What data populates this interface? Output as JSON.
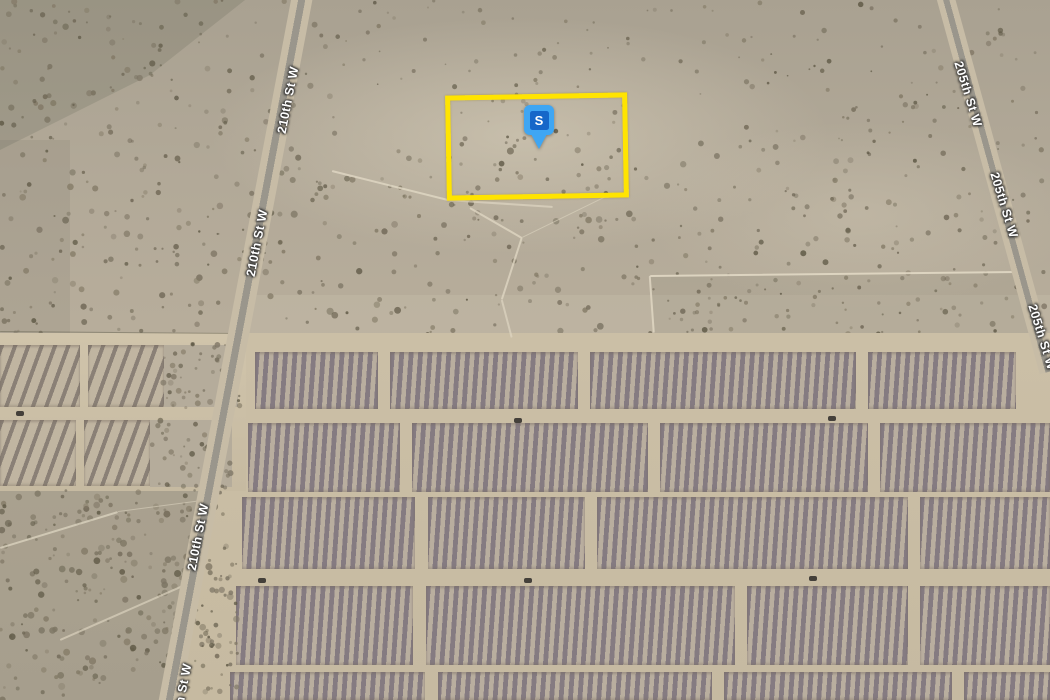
{
  "map": {
    "type": "satellite-aerial-view",
    "colors": {
      "desert": "#b1a897",
      "farm_dirt": "#d0c4ab",
      "farm_dirt_dark": "#c6baa1",
      "asphalt": "#9a968c",
      "road_shoulder": "#c7bca6",
      "panel_dark": "#857b81",
      "panel_light": "#b9ae9f",
      "panel_left_dark": "#8a8076",
      "panel_left_light": "#c0b5a1",
      "scrub": "#b5ac9b",
      "speckle_palette": [
        "#6f6755",
        "#7d7564",
        "#5f5946",
        "#837a66"
      ],
      "parcel_outline": "#ffe400",
      "marker_head": "#3fa6f3",
      "marker_inner": "#1667c9",
      "label_text": "#ffffff",
      "vehicle": "#44403a",
      "trail": "rgba(224,216,196,0.85)"
    },
    "marker": {
      "label": "S",
      "x": 524,
      "y": 105
    },
    "parcel": {
      "x": 446,
      "y": 94,
      "w": 182,
      "h": 105,
      "rot": -1,
      "stroke": 5
    },
    "road_labels": [
      {
        "text": "210th St W",
        "x": 288,
        "y": 100,
        "rot": -79
      },
      {
        "text": "210th St W",
        "x": 257,
        "y": 243,
        "rot": -79
      },
      {
        "text": "210th St W",
        "x": 198,
        "y": 537,
        "rot": -79
      },
      {
        "text": "210th St W",
        "x": 181,
        "y": 697,
        "rot": -79
      },
      {
        "text": "205th St W",
        "x": 968,
        "y": 94,
        "rot": 73
      },
      {
        "text": "205th St W",
        "x": 1004,
        "y": 205,
        "rot": 73
      },
      {
        "text": "205th St W",
        "x": 1042,
        "y": 337,
        "rot": 73
      }
    ],
    "roads": [
      {
        "name": "210th St W",
        "x1": 303,
        "y1": -10,
        "x2": 167,
        "y2": 710,
        "asphalt": 7,
        "shoulder": 7
      },
      {
        "name": "205th St W",
        "x1": 943,
        "y1": -10,
        "x2": 1048,
        "y2": 372,
        "asphalt": 6,
        "shoulder": 6
      }
    ],
    "solar_farm": {
      "grounds": [
        {
          "poly": [
            [
              246,
              333
            ],
            [
              1050,
              333
            ],
            [
              1050,
              700
            ],
            [
              176,
              700
            ]
          ]
        },
        {
          "rect": [
            0,
            333,
            246,
            158
          ]
        }
      ],
      "bands_main": [
        {
          "y": 352,
          "h": 57,
          "segments": [
            [
              255,
              378
            ],
            [
              390,
              578
            ],
            [
              590,
              856
            ],
            [
              868,
              1016
            ]
          ]
        },
        {
          "y": 423,
          "h": 69,
          "segments": [
            [
              248,
              400
            ],
            [
              412,
              648
            ],
            [
              660,
              868
            ],
            [
              880,
              1050
            ]
          ]
        },
        {
          "y": 497,
          "h": 72,
          "segments": [
            [
              242,
              415
            ],
            [
              428,
              585
            ],
            [
              597,
              908
            ],
            [
              920,
              1050
            ]
          ]
        },
        {
          "y": 586,
          "h": 79,
          "segments": [
            [
              236,
              413
            ],
            [
              426,
              735
            ],
            [
              747,
              908
            ],
            [
              920,
              1050
            ]
          ]
        },
        {
          "y": 672,
          "h": 28,
          "segments": [
            [
              230,
              425
            ],
            [
              438,
              712
            ],
            [
              724,
              952
            ],
            [
              964,
              1050
            ]
          ]
        }
      ],
      "bands_left": [
        {
          "y": 345,
          "h": 62,
          "segments": [
            [
              0,
              80
            ],
            [
              88,
              164
            ]
          ]
        },
        {
          "y": 420,
          "h": 66,
          "segments": [
            [
              0,
              76
            ],
            [
              84,
              150
            ]
          ]
        }
      ],
      "scrub_patches": [
        {
          "rect": [
            164,
            345,
            74,
            62
          ]
        },
        {
          "rect": [
            150,
            420,
            82,
            67
          ]
        }
      ],
      "vehicles": [
        [
          20,
          413
        ],
        [
          518,
          420
        ],
        [
          832,
          418
        ],
        [
          262,
          580
        ],
        [
          528,
          580
        ],
        [
          813,
          578
        ]
      ]
    },
    "terrain": {
      "tints": [
        {
          "poly": [
            [
              0,
              0
            ],
            [
              245,
              0
            ],
            [
              150,
              75
            ],
            [
              0,
              150
            ]
          ],
          "color": "rgba(84,86,72,0.18)"
        },
        {
          "rect": [
            0,
            140,
            70,
            220
          ],
          "color": "rgba(92,90,76,0.10)"
        },
        {
          "ellipse": [
            520,
            135,
            430,
            165
          ],
          "color": "rgba(222,213,192,0.50)"
        },
        {
          "ellipse": [
            860,
            215,
            300,
            130
          ],
          "color": "rgba(214,205,184,0.32)"
        },
        {
          "rect": [
            240,
            295,
            810,
            40
          ],
          "color": "rgba(208,199,178,0.25)"
        },
        {
          "rect": [
            0,
            480,
            240,
            220
          ],
          "color": "rgba(100,96,80,0.10)"
        },
        {
          "poly": [
            [
              650,
              276
            ],
            [
              1020,
              272
            ],
            [
              1035,
              333
            ],
            [
              655,
              333
            ]
          ],
          "color": "rgba(120,114,95,0.10)"
        }
      ],
      "lines": [
        {
          "p1": [
            0,
            332
          ],
          "p2": [
            237,
            334
          ],
          "w": 1.2,
          "color": "rgba(110,105,88,0.55)"
        },
        {
          "p1": [
            650,
            276
          ],
          "p2": [
            1018,
            272
          ],
          "w": 1.5,
          "color": "rgba(225,216,196,0.90)"
        },
        {
          "p1": [
            650,
            276
          ],
          "p2": [
            654,
            333
          ],
          "w": 1.5,
          "color": "rgba(225,216,196,0.80)"
        },
        {
          "p1": [
            332,
            171
          ],
          "p2": [
            448,
            200
          ],
          "w": 1.5,
          "color": "rgba(222,214,194,0.85)"
        },
        {
          "p1": [
            448,
            200
          ],
          "p2": [
            553,
            207
          ],
          "w": 1.5,
          "color": "rgba(222,214,194,0.70)"
        },
        {
          "p1": [
            470,
            208
          ],
          "p2": [
            522,
            238
          ],
          "w": 1.5,
          "color": "rgba(222,214,194,0.80)"
        },
        {
          "p1": [
            522,
            238
          ],
          "p2": [
            502,
            300
          ],
          "w": 1.5,
          "color": "rgba(222,214,194,0.80)"
        },
        {
          "p1": [
            502,
            300
          ],
          "p2": [
            512,
            338
          ],
          "w": 1.5,
          "color": "rgba(222,214,194,0.70)"
        },
        {
          "p1": [
            522,
            238
          ],
          "p2": [
            614,
            193
          ],
          "w": 1.2,
          "color": "rgba(222,214,194,0.60)"
        },
        {
          "p1": [
            0,
            548
          ],
          "p2": [
            118,
            512
          ],
          "w": 1.5,
          "color": "rgba(218,210,190,0.80)"
        },
        {
          "p1": [
            118,
            512
          ],
          "p2": [
            210,
            500
          ],
          "w": 1.2,
          "color": "rgba(218,210,190,0.60)"
        },
        {
          "p1": [
            60,
            640
          ],
          "p2": [
            185,
            585
          ],
          "w": 1.5,
          "color": "rgba(218,210,190,0.70)"
        }
      ],
      "speckle_regions_under": [
        {
          "x": 0,
          "y": 0,
          "w": 345,
          "h": 185,
          "n": 150,
          "rmin": 1,
          "rmax": 3.2,
          "seed": 11
        },
        {
          "x": 345,
          "y": 0,
          "w": 400,
          "h": 95,
          "n": 55,
          "rmin": 0.8,
          "rmax": 2.6,
          "seed": 22
        },
        {
          "x": 745,
          "y": 0,
          "w": 305,
          "h": 145,
          "n": 70,
          "rmin": 0.8,
          "rmax": 2.8,
          "seed": 33
        },
        {
          "x": 0,
          "y": 185,
          "w": 255,
          "h": 150,
          "n": 110,
          "rmin": 1,
          "rmax": 3.4,
          "seed": 44
        },
        {
          "x": 255,
          "y": 150,
          "w": 450,
          "h": 185,
          "n": 170,
          "rmin": 1,
          "rmax": 3.6,
          "seed": 55
        },
        {
          "x": 700,
          "y": 140,
          "w": 345,
          "h": 195,
          "n": 120,
          "rmin": 1,
          "rmax": 3.0,
          "seed": 66
        },
        {
          "x": 452,
          "y": 100,
          "w": 175,
          "h": 98,
          "n": 32,
          "rmin": 1,
          "rmax": 2.6,
          "seed": 77
        },
        {
          "x": 650,
          "y": 276,
          "w": 370,
          "h": 57,
          "n": 55,
          "rmin": 1,
          "rmax": 2.4,
          "seed": 88
        }
      ],
      "speckle_regions_over": [
        {
          "x": 0,
          "y": 488,
          "w": 238,
          "h": 212,
          "n": 250,
          "rmin": 1,
          "rmax": 3.6,
          "seed": 99
        },
        {
          "x": 162,
          "y": 343,
          "w": 78,
          "h": 66,
          "n": 48,
          "rmin": 1,
          "rmax": 3.0,
          "seed": 111
        },
        {
          "x": 148,
          "y": 418,
          "w": 84,
          "h": 70,
          "n": 48,
          "rmin": 1,
          "rmax": 3.0,
          "seed": 122
        },
        {
          "x": 168,
          "y": 560,
          "w": 70,
          "h": 140,
          "n": 40,
          "rmin": 1,
          "rmax": 2.6,
          "seed": 133
        }
      ]
    }
  }
}
